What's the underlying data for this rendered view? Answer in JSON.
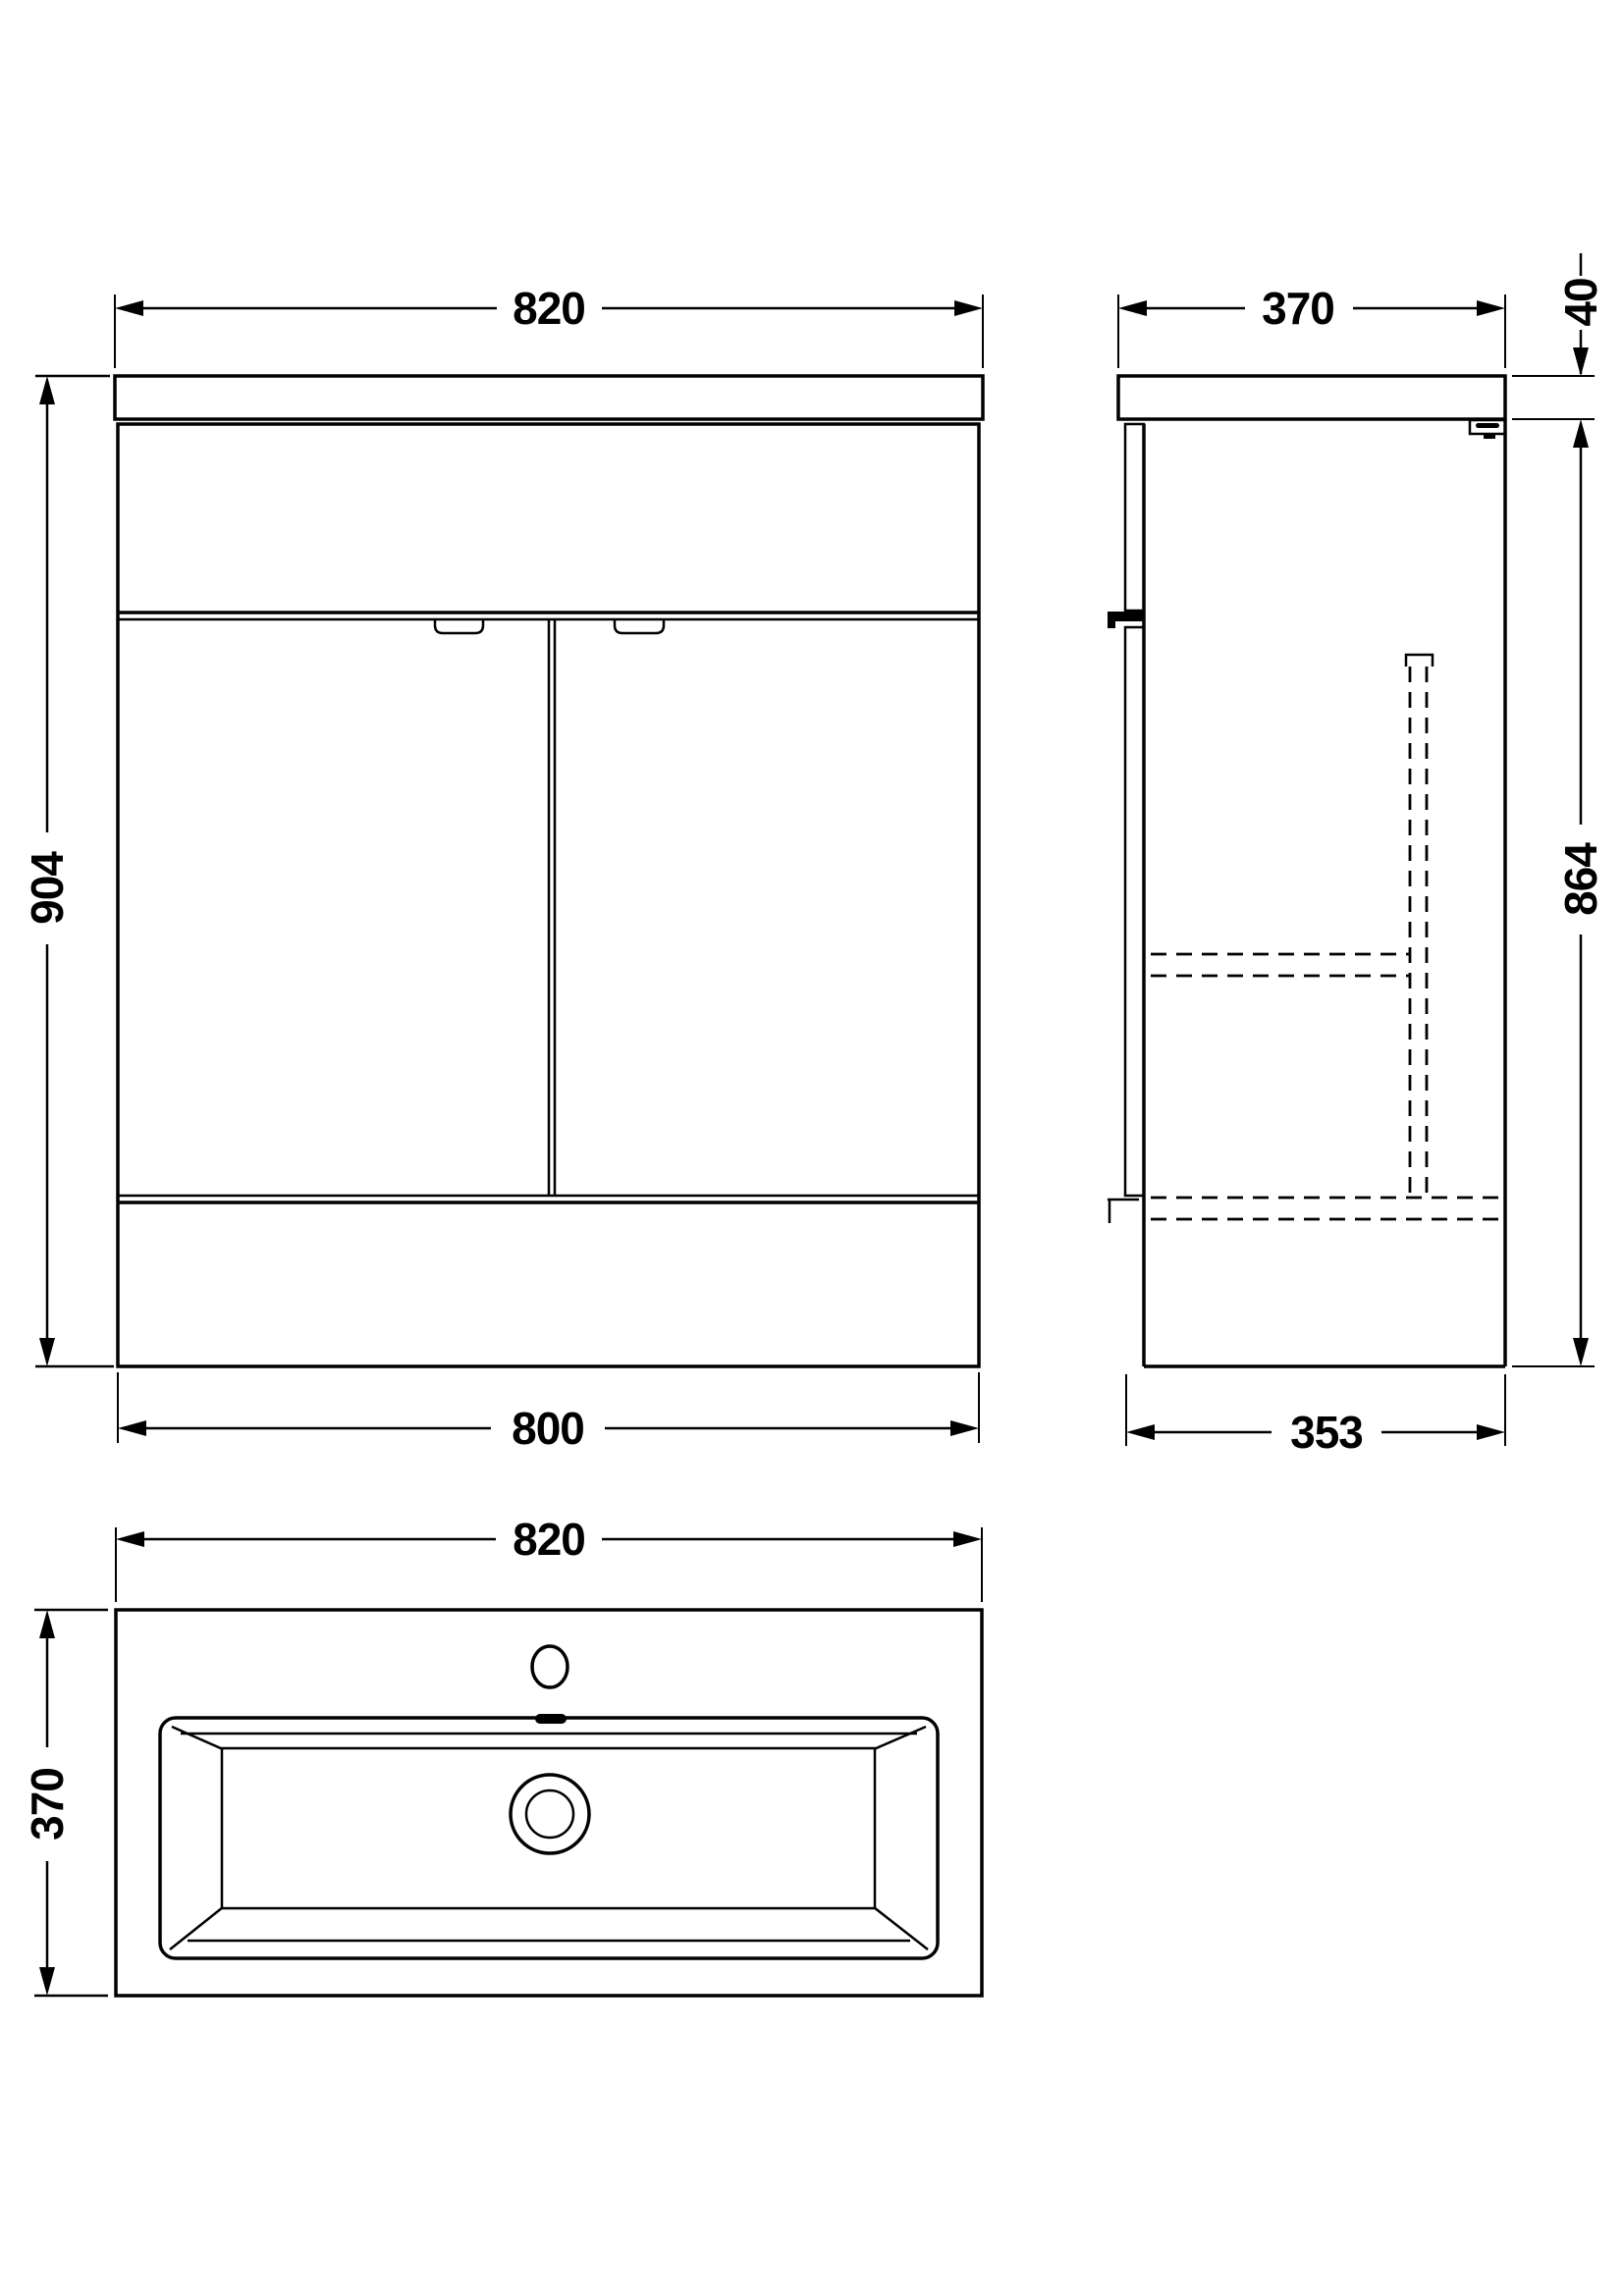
{
  "drawing": {
    "type": "technical-dimension-drawing",
    "subject": "floor-standing vanity unit with basin, three orthographic views",
    "colors": {
      "line": "#000000",
      "background": "#ffffff"
    },
    "views": {
      "front": {
        "width_top": "820",
        "height": "904",
        "width_bottom": "800"
      },
      "side": {
        "depth_top": "370",
        "countertop_thickness": "40",
        "height": "864",
        "depth_bottom": "353"
      },
      "top": {
        "width": "820",
        "depth": "370"
      }
    }
  }
}
